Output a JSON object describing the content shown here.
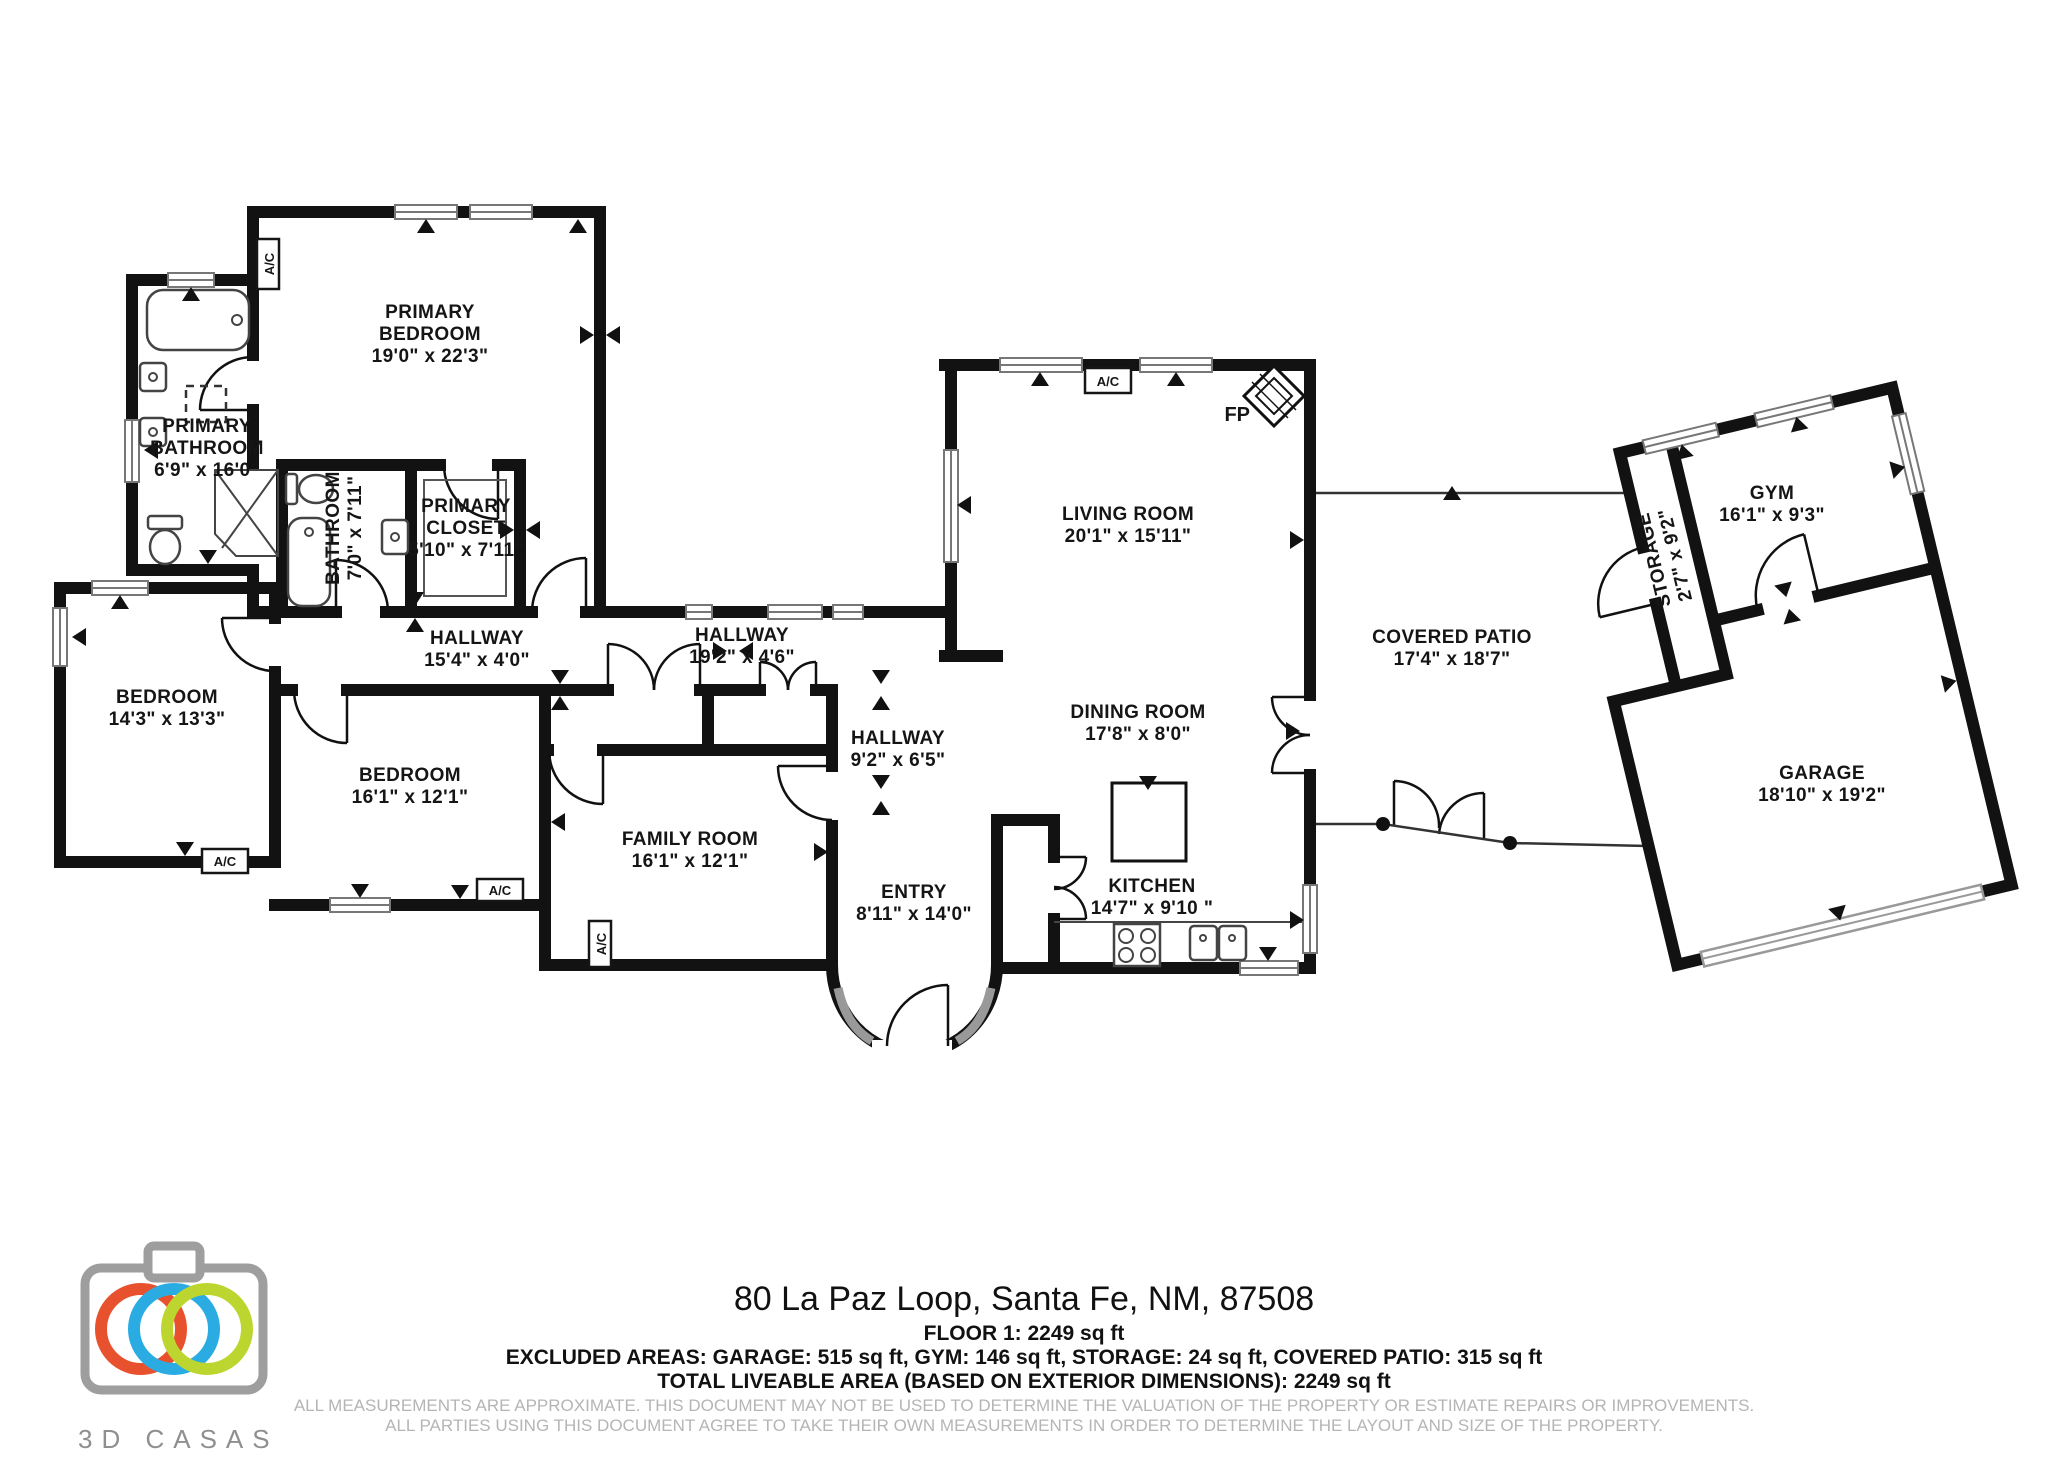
{
  "floorplan": {
    "rooms": {
      "primary_bedroom": {
        "name1": "PRIMARY",
        "name2": "BEDROOM",
        "dims": "19'0\" x 22'3\""
      },
      "primary_bathroom": {
        "name1": "PRIMARY",
        "name2": "BATHROOM",
        "dims": "6'9\" x 16'0\""
      },
      "bathroom": {
        "name": "BATHROOM",
        "dims": "7'0\" x 7'11\""
      },
      "primary_closet": {
        "name1": "PRIMARY",
        "name2": "CLOSET",
        "dims": "5'10\" x 7'11\""
      },
      "hallway_west": {
        "name": "HALLWAY",
        "dims": "15'4\" x 4'0\""
      },
      "hallway_east": {
        "name": "HALLWAY",
        "dims": "19'2\" x 4'6\""
      },
      "hallway_south": {
        "name": "HALLWAY",
        "dims": "9'2\" x 6'5\""
      },
      "bedroom_west": {
        "name": "BEDROOM",
        "dims": "14'3\" x 13'3\""
      },
      "bedroom_mid": {
        "name": "BEDROOM",
        "dims": "16'1\" x 12'1\""
      },
      "family_room": {
        "name": "FAMILY ROOM",
        "dims": "16'1\" x 12'1\""
      },
      "entry": {
        "name": "ENTRY",
        "dims": "8'11\" x 14'0\""
      },
      "living_room": {
        "name": "LIVING ROOM",
        "dims": "20'1\" x 15'11\""
      },
      "dining_room": {
        "name": "DINING ROOM",
        "dims": "17'8\" x 8'0\""
      },
      "kitchen": {
        "name": "KITCHEN",
        "dims": "14'7\" x 9'10 \""
      },
      "covered_patio": {
        "name": "COVERED PATIO",
        "dims": "17'4\" x 18'7\""
      },
      "storage": {
        "name": "STORAGE",
        "dims": "2'7\" x 9'2\""
      },
      "gym": {
        "name": "GYM",
        "dims": "16'1\" x 9'3\""
      },
      "garage": {
        "name": "GARAGE",
        "dims": "18'10\" x 19'2\""
      }
    },
    "markers": {
      "ac": "A/C",
      "fp": "FP"
    }
  },
  "footer": {
    "address": "80 La Paz Loop, Santa Fe, NM, 87508",
    "floor_line": "FLOOR 1: 2249 sq ft",
    "excluded_line": "EXCLUDED AREAS: GARAGE: 515 sq ft, GYM: 146 sq ft, STORAGE: 24 sq ft, COVERED PATIO: 315 sq ft",
    "total_line": "TOTAL LIVEABLE AREA (BASED ON EXTERIOR DIMENSIONS): 2249 sq ft",
    "disclaimer1": "ALL MEASUREMENTS ARE APPROXIMATE. THIS DOCUMENT MAY NOT BE USED TO DETERMINE THE VALUATION OF THE PROPERTY OR ESTIMATE REPAIRS OR IMPROVEMENTS.",
    "disclaimer2": "ALL PARTIES USING THIS DOCUMENT AGREE TO TAKE THEIR OWN MEASUREMENTS IN ORDER TO DETERMINE THE LAYOUT AND SIZE OF THE PROPERTY.",
    "logo_text": "3D CASAS"
  }
}
